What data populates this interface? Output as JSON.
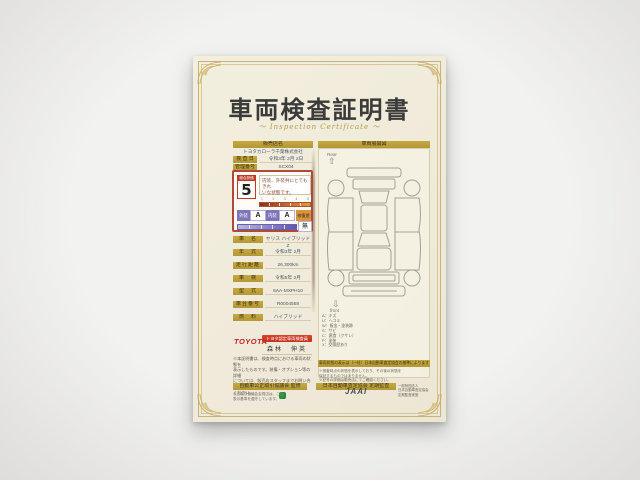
{
  "certificate": {
    "title": "車両検査証明書",
    "subtitle": "〜  Inspection Certificate  〜",
    "dealer": {
      "header": "販売店名",
      "name": "トヨタカローラ千葉株式会社"
    },
    "meta_rows": [
      {
        "label": "検 査 日",
        "value": "令和3年 2月 2日"
      },
      {
        "label": "管理番号",
        "value": "SCX04"
      }
    ],
    "rating": {
      "header": "総合評価",
      "score": "5",
      "comment_line1": "内装、外装共にとてもきれ",
      "comment_line2": "いな状態です。",
      "scale_ticks": [
        "1",
        "2",
        "3",
        "4",
        "5"
      ],
      "exterior_label": "外装",
      "exterior_value": "A",
      "interior_label": "内装",
      "interior_value": "A",
      "repair_label": "修復歴",
      "repair_value": "無"
    },
    "spec_rows": [
      {
        "label": "車　名",
        "value": "ヤリス ハイブリッドZ"
      },
      {
        "label": "年　式",
        "value": "令和3年 2月"
      },
      {
        "label": "走行距離",
        "value": "26,300km"
      },
      {
        "label": "車　検",
        "value": "令和5年 2月"
      },
      {
        "label": "型　式",
        "value": "6AA-MXPH10"
      },
      {
        "label": "車台番号",
        "value": "R0004558"
      },
      {
        "label": "燃　料",
        "value": "ハイブリッド"
      }
    ],
    "inspector": {
      "brand": "TOYOTA",
      "title_bar": "トヨタ認定車両検査員",
      "name": "森林　伸英"
    },
    "disclaimer_lines": [
      "※本証明書は、検査時点における車両の状態を",
      "表示したものです。装備・オプション等の詳細",
      "については、販売店スタッフまでお問い合わせ",
      "ください。"
    ],
    "diagram": {
      "header": "車両展開図",
      "rear_label": "Rear",
      "front_label": "front",
      "rear_arrow": "⇧",
      "front_arrow": "⇩",
      "legend_lines": [
        "A：キズ",
        "U：ヘコミ",
        "W：板金・塗装跡",
        "S：サビ",
        "C：腐食（クサレ）",
        "P：塗装",
        "X：交換歴あり"
      ],
      "note_bar": "車両状態の表示は（一社）日本自動車査定協会の基準によります",
      "fineprint_lines": [
        "※検査時点の状態を表示しており、その後の状態を",
        "保証するものではありません。",
        "※記号の詳細は販売店にてご確認ください。"
      ]
    },
    "footer": {
      "left_bar": "自動車公正取引協議会 監修",
      "right_bar": "日本自動車査定協会 定期監査",
      "left_lines": [
        "公正取引協議会会員店は、この",
        "表示基準を遵守しています。"
      ],
      "jaai": "JAAI",
      "right_lines": [
        "一般財団法人",
        "日本自動車査定協会",
        "定期監査実施"
      ]
    },
    "colors": {
      "gold": "#b3973a",
      "red": "#c03a28",
      "purple": "#7e76bd",
      "cream": "#f0ebdb"
    }
  }
}
